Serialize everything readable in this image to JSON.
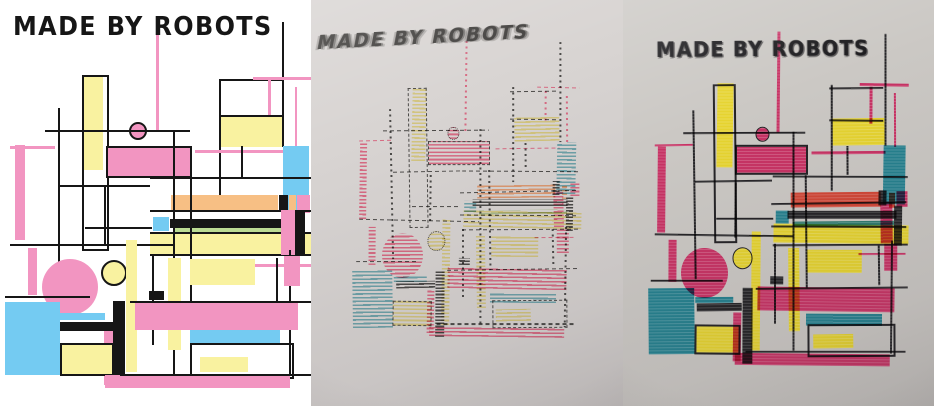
{
  "artwork_title": "MADE BY ROBOTS",
  "panels": [
    {
      "id": "digital",
      "kind": "digital-design",
      "mode": "flat",
      "bg": "#ffffff",
      "title": {
        "text": "MADE BY ROBOTS",
        "x": 13,
        "y": 13,
        "size": 26,
        "ls": 1.5,
        "scaleX": 0.92,
        "skew": 0,
        "rotate": 0,
        "color": "#161616"
      },
      "palette": {
        "pink": "#f295c1",
        "yellow": "#f9f2a0",
        "blue": "#74cbf2",
        "orange": "#f7bf84",
        "green": "#bcdc94",
        "black": "#161616"
      },
      "transform": {
        "sx": 1,
        "sy": 1,
        "ox": 0,
        "oy": 0
      }
    },
    {
      "id": "plot-sketch",
      "kind": "pen-plotter-sketch-photo",
      "mode": "hatch",
      "bg": "#d8d4d2",
      "title": {
        "text": "MADE BY ROBOTS",
        "x": 8,
        "y": 33,
        "size": 19,
        "ls": 2,
        "scaleX": 0.97,
        "skew": -14,
        "rotate": -3,
        "color": "#343230"
      },
      "palette": {
        "pink": "#d6607b",
        "yellow": "#d2c276",
        "blue": "#649ca4",
        "orange": "#dd9468",
        "green": "#a4b786",
        "black": "#3e3c3a"
      },
      "transform": {
        "sx": 0.73,
        "sy": 0.8,
        "ox": 40,
        "oy": 26
      }
    },
    {
      "id": "plot-marker",
      "kind": "marker-plot-photo",
      "mode": "marker",
      "bg": "#cbc8c4",
      "title": {
        "text": "MADE BY ROBOTS",
        "x": 33,
        "y": 39,
        "size": 21,
        "ls": 1.5,
        "scaleX": 0.92,
        "skew": 0,
        "rotate": -0.5,
        "color": "#1b1a1d"
      },
      "palette": {
        "pink": "#c72c60",
        "yellow": "#e7d428",
        "blue": "#1e7d8b",
        "orange": "#d2402f",
        "green": "#27786a",
        "black": "#1d1c1f"
      },
      "transform": {
        "sx": 0.84,
        "sy": 0.9,
        "ox": 23,
        "oy": 15
      }
    }
  ],
  "artwork": {
    "shapes": [
      {
        "k": "r",
        "c": "black",
        "x": 58,
        "y": 108,
        "w": 1.5,
        "h": 188
      },
      {
        "k": "r",
        "c": "pink",
        "x": 156,
        "y": 18,
        "w": 3,
        "h": 112
      },
      {
        "k": "r",
        "c": "black",
        "x": 282,
        "y": 22,
        "w": 2,
        "h": 125
      },
      {
        "k": "r",
        "c": "black",
        "x": 219,
        "y": 79,
        "w": 64,
        "h": 2
      },
      {
        "k": "r",
        "c": "pink",
        "x": 253,
        "y": 77,
        "w": 58,
        "h": 3
      },
      {
        "k": "r",
        "c": "pink",
        "x": 268,
        "y": 78,
        "w": 3,
        "h": 41
      },
      {
        "k": "r",
        "c": "pink",
        "x": 295,
        "y": 87,
        "w": 2,
        "h": 60
      },
      {
        "k": "r",
        "c": "yellow",
        "x": 220,
        "y": 117,
        "w": 62,
        "h": 30
      },
      {
        "k": "r",
        "c": "black",
        "x": 219,
        "y": 115,
        "w": 64,
        "h": 2
      },
      {
        "k": "r",
        "c": "black",
        "x": 219,
        "y": 79,
        "w": 2,
        "h": 118
      },
      {
        "k": "r",
        "c": "none",
        "b": 1,
        "x": 82,
        "y": 75,
        "w": 23,
        "h": 172
      },
      {
        "k": "r",
        "c": "yellow",
        "x": 84,
        "y": 77,
        "w": 19,
        "h": 93
      },
      {
        "k": "c",
        "c": "pink",
        "b": 1,
        "cx": 136,
        "cy": 129,
        "r": 7
      },
      {
        "k": "r",
        "c": "black",
        "x": 45,
        "y": 130,
        "w": 145,
        "h": 1.5
      },
      {
        "k": "r",
        "c": "pink",
        "x": 10,
        "y": 146,
        "w": 45,
        "h": 2.5
      },
      {
        "k": "r",
        "c": "pink",
        "x": 15,
        "y": 145,
        "w": 10,
        "h": 95
      },
      {
        "k": "r",
        "c": "pink",
        "b": 1,
        "x": 106,
        "y": 146,
        "w": 82,
        "h": 28
      },
      {
        "k": "r",
        "c": "pink",
        "x": 195,
        "y": 150,
        "w": 88,
        "h": 3
      },
      {
        "k": "r",
        "c": "blue",
        "x": 283,
        "y": 146,
        "w": 26,
        "h": 65
      },
      {
        "k": "r",
        "c": "black",
        "x": 150,
        "y": 177,
        "w": 161,
        "h": 1.5
      },
      {
        "k": "r",
        "c": "black",
        "x": 241,
        "y": 146,
        "w": 1.5,
        "h": 32
      },
      {
        "k": "r",
        "c": "black",
        "x": 58,
        "y": 185,
        "w": 92,
        "h": 1.5
      },
      {
        "k": "r",
        "c": "black",
        "x": 104,
        "y": 185,
        "w": 1.5,
        "h": 61
      },
      {
        "k": "r",
        "c": "black",
        "x": 85,
        "y": 227,
        "w": 67,
        "h": 1.5
      },
      {
        "k": "r",
        "c": "orange",
        "x": 171,
        "y": 195,
        "w": 107,
        "h": 17
      },
      {
        "k": "r",
        "c": "black",
        "x": 279,
        "y": 195,
        "w": 9,
        "h": 17
      },
      {
        "k": "r",
        "c": "orange",
        "x": 289,
        "y": 195,
        "w": 7,
        "h": 17
      },
      {
        "k": "r",
        "c": "pink",
        "x": 297,
        "y": 195,
        "w": 13,
        "h": 18
      },
      {
        "k": "r",
        "c": "black",
        "x": 150,
        "y": 210,
        "w": 161,
        "h": 1.5
      },
      {
        "k": "r",
        "c": "blue",
        "x": 153,
        "y": 217,
        "w": 16,
        "h": 14
      },
      {
        "k": "r",
        "c": "black",
        "x": 170,
        "y": 219,
        "w": 130,
        "h": 9
      },
      {
        "k": "r",
        "c": "green",
        "x": 175,
        "y": 228,
        "w": 120,
        "h": 5
      },
      {
        "k": "r",
        "c": "yellow",
        "x": 150,
        "y": 233,
        "w": 161,
        "h": 21
      },
      {
        "k": "r",
        "c": "black",
        "x": 150,
        "y": 232,
        "w": 161,
        "h": 1.5
      },
      {
        "k": "r",
        "c": "black",
        "x": 150,
        "y": 254,
        "w": 161,
        "h": 1.5
      },
      {
        "k": "r",
        "c": "pink",
        "x": 281,
        "y": 210,
        "w": 14,
        "h": 45
      },
      {
        "k": "r",
        "c": "black",
        "x": 295,
        "y": 211,
        "w": 10,
        "h": 44
      },
      {
        "k": "r",
        "c": "black",
        "x": 173,
        "y": 131,
        "w": 1.5,
        "h": 244
      },
      {
        "k": "r",
        "c": "black",
        "x": 190,
        "y": 177,
        "w": 1.5,
        "h": 125
      },
      {
        "k": "r",
        "c": "black",
        "x": 10,
        "y": 244,
        "w": 165,
        "h": 1.5
      },
      {
        "k": "r",
        "c": "pink",
        "x": 28,
        "y": 248,
        "w": 9,
        "h": 47
      },
      {
        "k": "c",
        "c": "pink",
        "cx": 70,
        "cy": 287,
        "r": 28
      },
      {
        "k": "c",
        "c": "yellow",
        "b": 1,
        "cx": 112,
        "cy": 271,
        "r": 11
      },
      {
        "k": "r",
        "c": "yellow",
        "x": 126,
        "y": 240,
        "w": 11,
        "h": 132
      },
      {
        "k": "r",
        "c": "black",
        "x": 5,
        "y": 296,
        "w": 85,
        "h": 1.5
      },
      {
        "k": "r",
        "c": "blue",
        "x": 5,
        "y": 302,
        "w": 55,
        "h": 73
      },
      {
        "k": "r",
        "c": "pink",
        "x": 104,
        "y": 331,
        "w": 10,
        "h": 54
      },
      {
        "k": "r",
        "c": "black",
        "x": 113,
        "y": 301,
        "w": 12,
        "h": 84
      },
      {
        "k": "r",
        "c": "blue",
        "x": 60,
        "y": 313,
        "w": 45,
        "h": 7
      },
      {
        "k": "r",
        "c": "black",
        "x": 60,
        "y": 322,
        "w": 53,
        "h": 9
      },
      {
        "k": "r",
        "c": "yellow",
        "b": 1,
        "x": 60,
        "y": 343,
        "w": 50,
        "h": 29
      },
      {
        "k": "r",
        "c": "black",
        "x": 152,
        "y": 256,
        "w": 1.5,
        "h": 89
      },
      {
        "k": "r",
        "c": "yellow",
        "x": 168,
        "y": 258,
        "w": 13,
        "h": 92
      },
      {
        "k": "r",
        "c": "black",
        "x": 149,
        "y": 291,
        "w": 15,
        "h": 9
      },
      {
        "k": "r",
        "c": "yellow",
        "x": 190,
        "y": 259,
        "w": 65,
        "h": 26
      },
      {
        "k": "r",
        "c": "pink",
        "x": 255,
        "y": 264,
        "w": 56,
        "h": 2.5
      },
      {
        "k": "r",
        "c": "black",
        "x": 276,
        "y": 258,
        "w": 1.5,
        "h": 44
      },
      {
        "k": "r",
        "c": "black",
        "x": 289,
        "y": 250,
        "w": 1.5,
        "h": 125
      },
      {
        "k": "r",
        "c": "pink",
        "x": 284,
        "y": 256,
        "w": 16,
        "h": 30
      },
      {
        "k": "r",
        "c": "black",
        "x": 130,
        "y": 301,
        "w": 181,
        "h": 1.5
      },
      {
        "k": "r",
        "c": "pink",
        "x": 135,
        "y": 303,
        "w": 163,
        "h": 27
      },
      {
        "k": "r",
        "c": "blue",
        "x": 190,
        "y": 330,
        "w": 90,
        "h": 13
      },
      {
        "k": "r",
        "c": "none",
        "b": 1,
        "x": 190,
        "y": 343,
        "w": 100,
        "h": 32
      },
      {
        "k": "r",
        "c": "yellow",
        "x": 200,
        "y": 357,
        "w": 48,
        "h": 15
      },
      {
        "k": "r",
        "c": "pink",
        "x": 105,
        "y": 375,
        "w": 185,
        "h": 13
      },
      {
        "k": "r",
        "c": "black",
        "x": 120,
        "y": 374,
        "w": 191,
        "h": 1.5
      }
    ]
  }
}
